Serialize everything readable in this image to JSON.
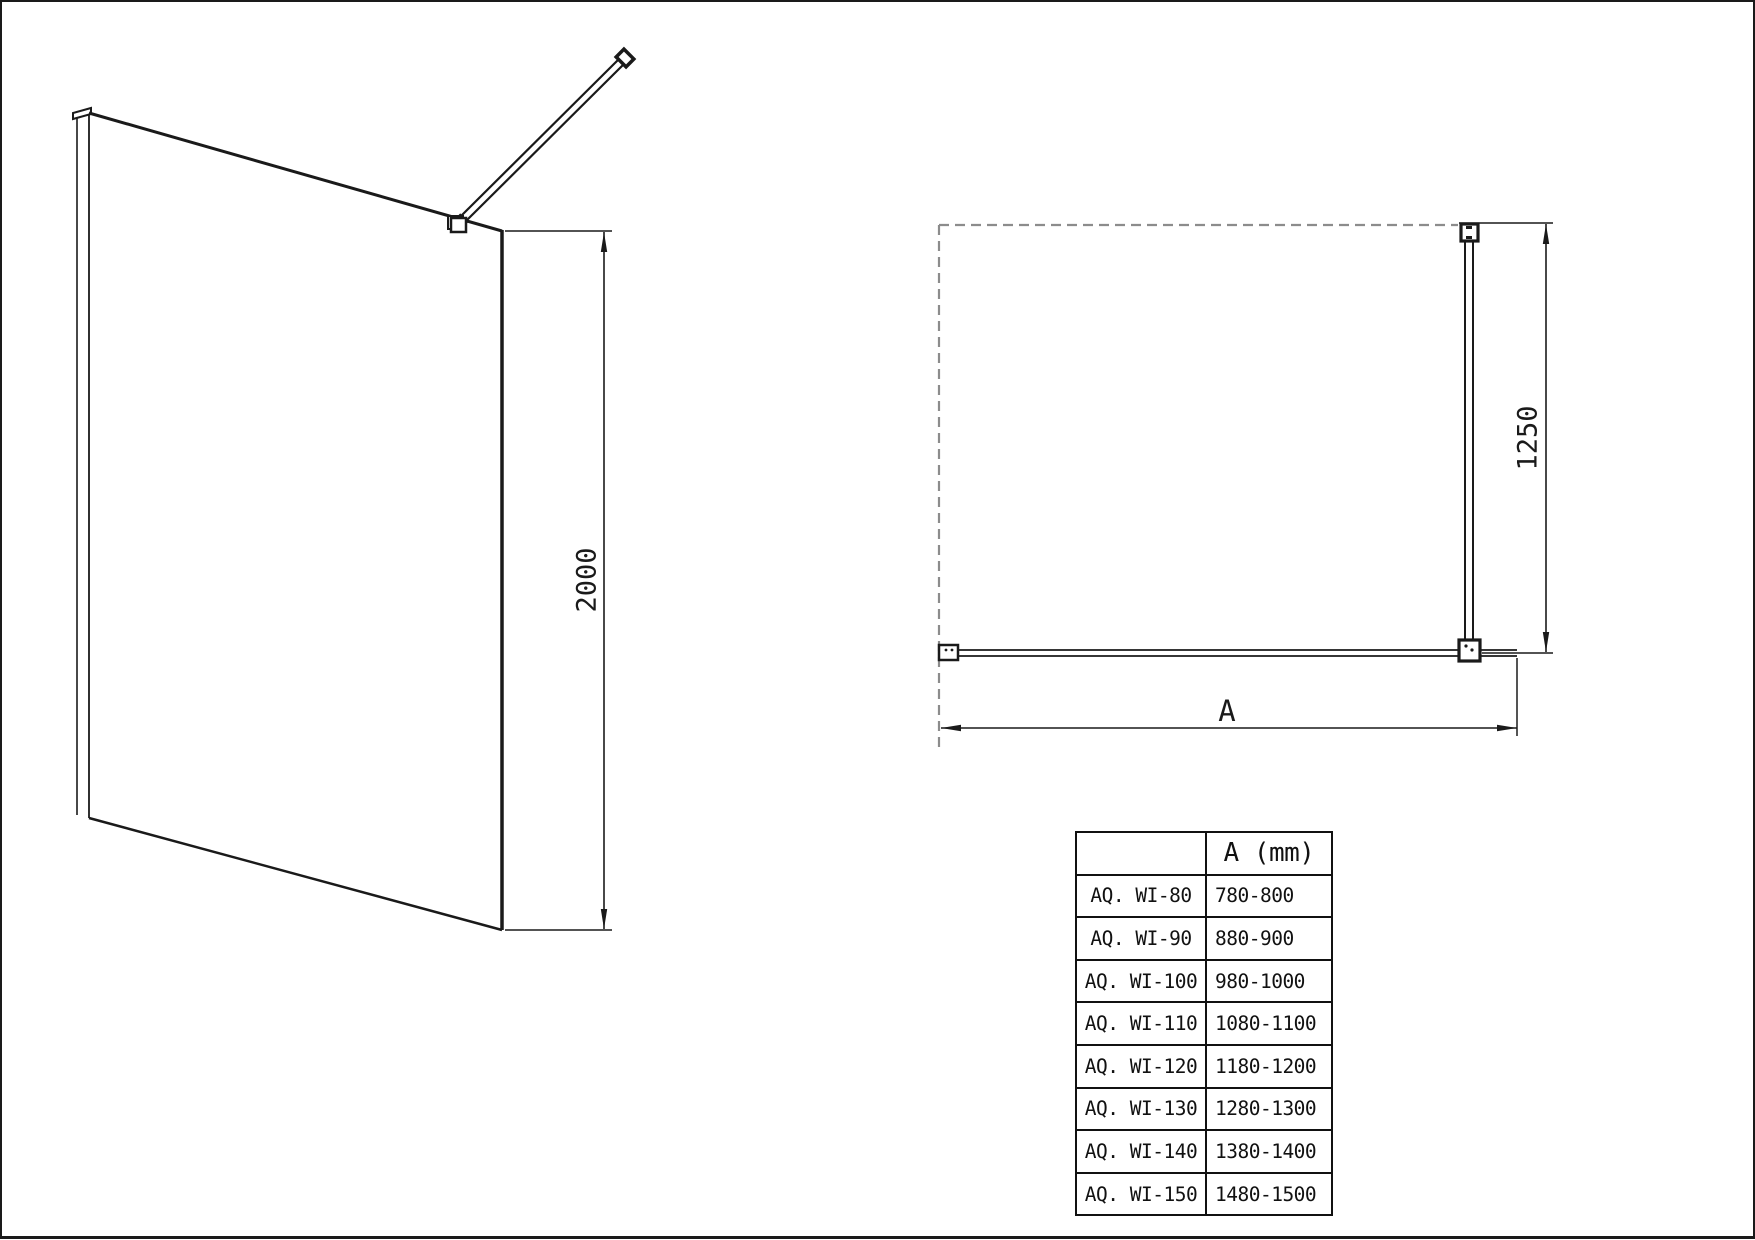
{
  "drawing": {
    "colors": {
      "line": "#1a1a1a",
      "dashed_wall_outline": "#8c8c8c",
      "background": "#ffffff"
    },
    "front_view": {
      "description-of-view": "perspective view of walk-in glass shower panel with wall profile and angled support bar",
      "height_dim_label": "2000"
    },
    "plan_view": {
      "description-of-view": "top view with dashed tray outline, glass panel and perpendicular support bar",
      "depth_dim_label": "1250",
      "width_dim_label": "A"
    },
    "table": {
      "header": {
        "model": "",
        "size": "A (mm)"
      },
      "rows": [
        {
          "model": "AQ. WI-80",
          "range": "780-800"
        },
        {
          "model": "AQ. WI-90",
          "range": "880-900"
        },
        {
          "model": "AQ. WI-100",
          "range": "980-1000"
        },
        {
          "model": "AQ. WI-110",
          "range": "1080-1100"
        },
        {
          "model": "AQ. WI-120",
          "range": "1180-1200"
        },
        {
          "model": "AQ. WI-130",
          "range": "1280-1300"
        },
        {
          "model": "AQ. WI-140",
          "range": "1380-1400"
        },
        {
          "model": "AQ. WI-150",
          "range": "1480-1500"
        }
      ]
    }
  }
}
